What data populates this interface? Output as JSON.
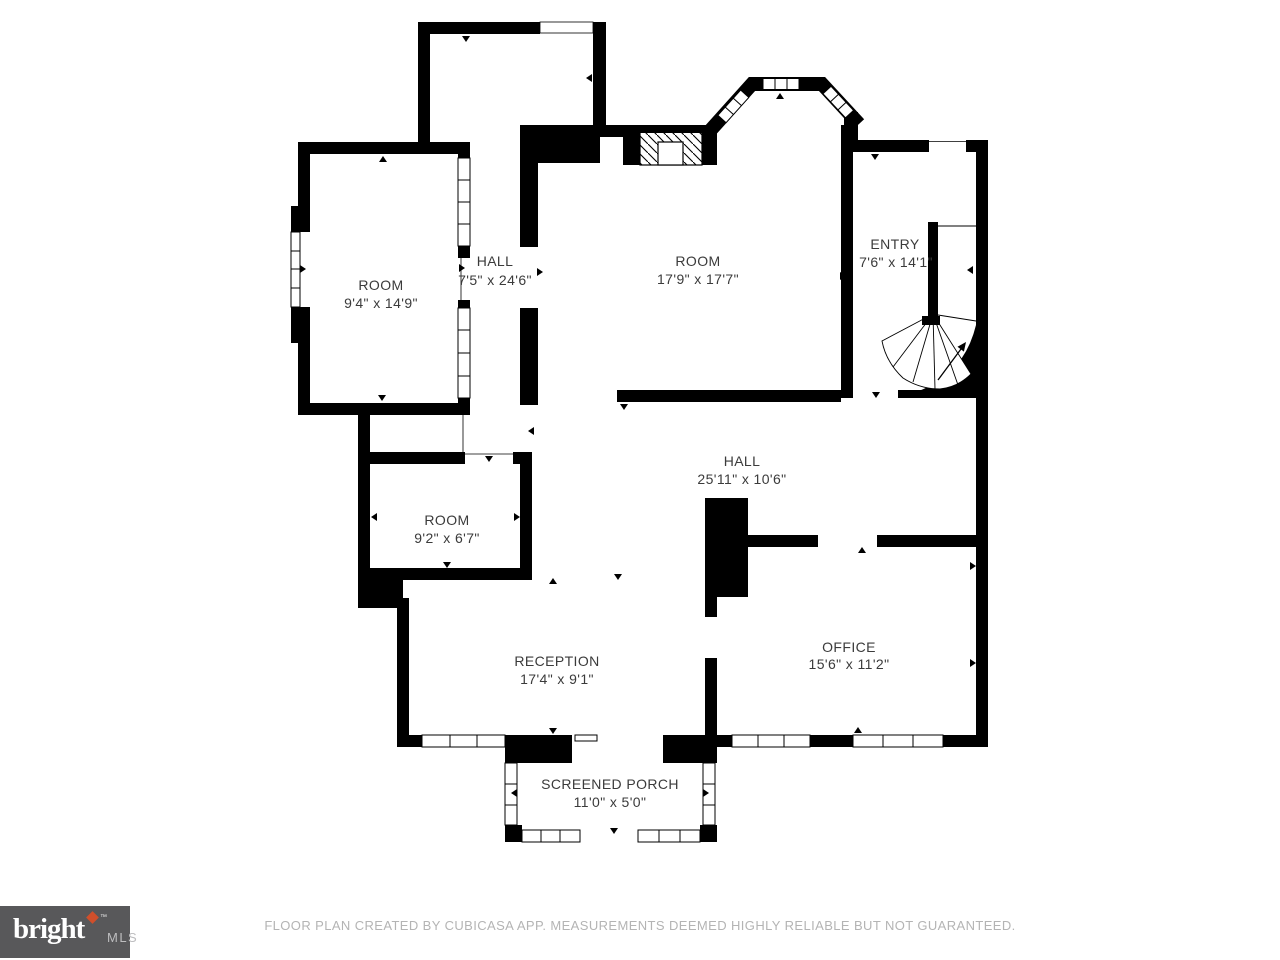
{
  "plan": {
    "rooms": [
      {
        "id": "room-top-left",
        "name": "ROOM",
        "dims": "9'4\" x 14'9\""
      },
      {
        "id": "hall-vertical",
        "name": "HALL",
        "dims": "7'5\" x 24'6\""
      },
      {
        "id": "room-main",
        "name": "ROOM",
        "dims": "17'9\" x 17'7\""
      },
      {
        "id": "entry",
        "name": "ENTRY",
        "dims": "7'6\" x 14'1\""
      },
      {
        "id": "hall-main",
        "name": "HALL",
        "dims": "25'11\" x 10'6\""
      },
      {
        "id": "room-small",
        "name": "ROOM",
        "dims": "9'2\" x 6'7\""
      },
      {
        "id": "reception",
        "name": "RECEPTION",
        "dims": "17'4\" x 9'1\""
      },
      {
        "id": "office",
        "name": "OFFICE",
        "dims": "15'6\" x 11'2\""
      },
      {
        "id": "screened-porch",
        "name": "SCREENED PORCH",
        "dims": "11'0\" x 5'0\""
      }
    ]
  },
  "footer": {
    "disclaimer": "FLOOR PLAN CREATED BY CUBICASA APP. MEASUREMENTS DEEMED HIGHLY RELIABLE BUT NOT GUARANTEED.",
    "logo": {
      "brand": "bright",
      "trademark": "™",
      "suffix": "MLS"
    }
  },
  "colors": {
    "background": "#ffffff",
    "walls": "#000000",
    "room_text": "#3b3b3b",
    "disclaimer_text": "#b4b4b4",
    "logo_background": "#58585a",
    "logo_brand_text": "#ffffff",
    "logo_suffix_text": "#bdbdbf",
    "logo_accent": "#d04f2b"
  }
}
